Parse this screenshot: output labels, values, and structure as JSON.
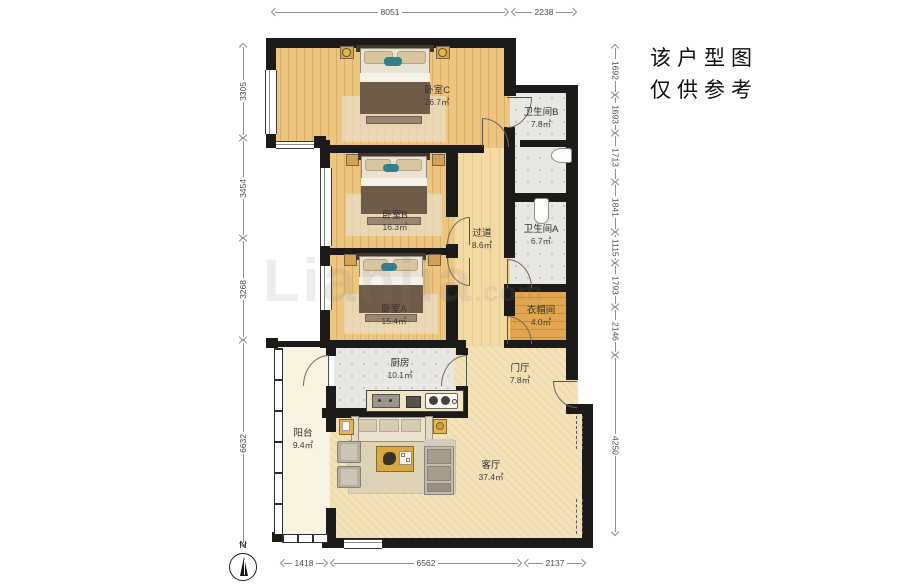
{
  "notice": {
    "line1": "该户型图",
    "line2": "仅供参考"
  },
  "watermark": {
    "main": "Lianjia",
    "suffix": ".com"
  },
  "compass": {
    "label": "N"
  },
  "rooms": [
    {
      "id": "bedroom-c",
      "name": "卧室C",
      "area": "26.7㎡"
    },
    {
      "id": "bathroom-b",
      "name": "卫生间B",
      "area": "7.8㎡"
    },
    {
      "id": "bedroom-b",
      "name": "卧室B",
      "area": "16.3㎡"
    },
    {
      "id": "hallway",
      "name": "过道",
      "area": "8.6㎡"
    },
    {
      "id": "bathroom-a",
      "name": "卫生间A",
      "area": "6.7㎡"
    },
    {
      "id": "bedroom-a",
      "name": "卧室A",
      "area": "15.4㎡"
    },
    {
      "id": "cloakroom",
      "name": "衣帽间",
      "area": "4.0㎡"
    },
    {
      "id": "kitchen",
      "name": "厨房",
      "area": "10.1㎡"
    },
    {
      "id": "foyer",
      "name": "门厅",
      "area": "7.8㎡"
    },
    {
      "id": "balcony",
      "name": "阳台",
      "area": "9.4㎡"
    },
    {
      "id": "living-room",
      "name": "客厅",
      "area": "37.4㎡"
    }
  ],
  "dimensions": {
    "top": [
      "8051",
      "2238"
    ],
    "bottom": [
      "1418",
      "6562",
      "2137"
    ],
    "left": [
      "3305",
      "3454",
      "3268",
      "6632"
    ],
    "right": [
      "1692",
      "1693",
      "1713",
      "1841",
      "1115",
      "1793",
      "2146",
      "4250"
    ]
  },
  "colors": {
    "wall": "#1c1b19",
    "wood_floor": "#ecc57f",
    "corridor_floor": "#f3d9a2",
    "cloakroom_floor": "#e2a64f",
    "tile_floor": "#e8e7e3",
    "living_floor": "#f4e3ba",
    "balcony_floor": "#f8f4e1",
    "accent_yellow": "#e6b655",
    "accent_teal": "#2e7f92"
  }
}
